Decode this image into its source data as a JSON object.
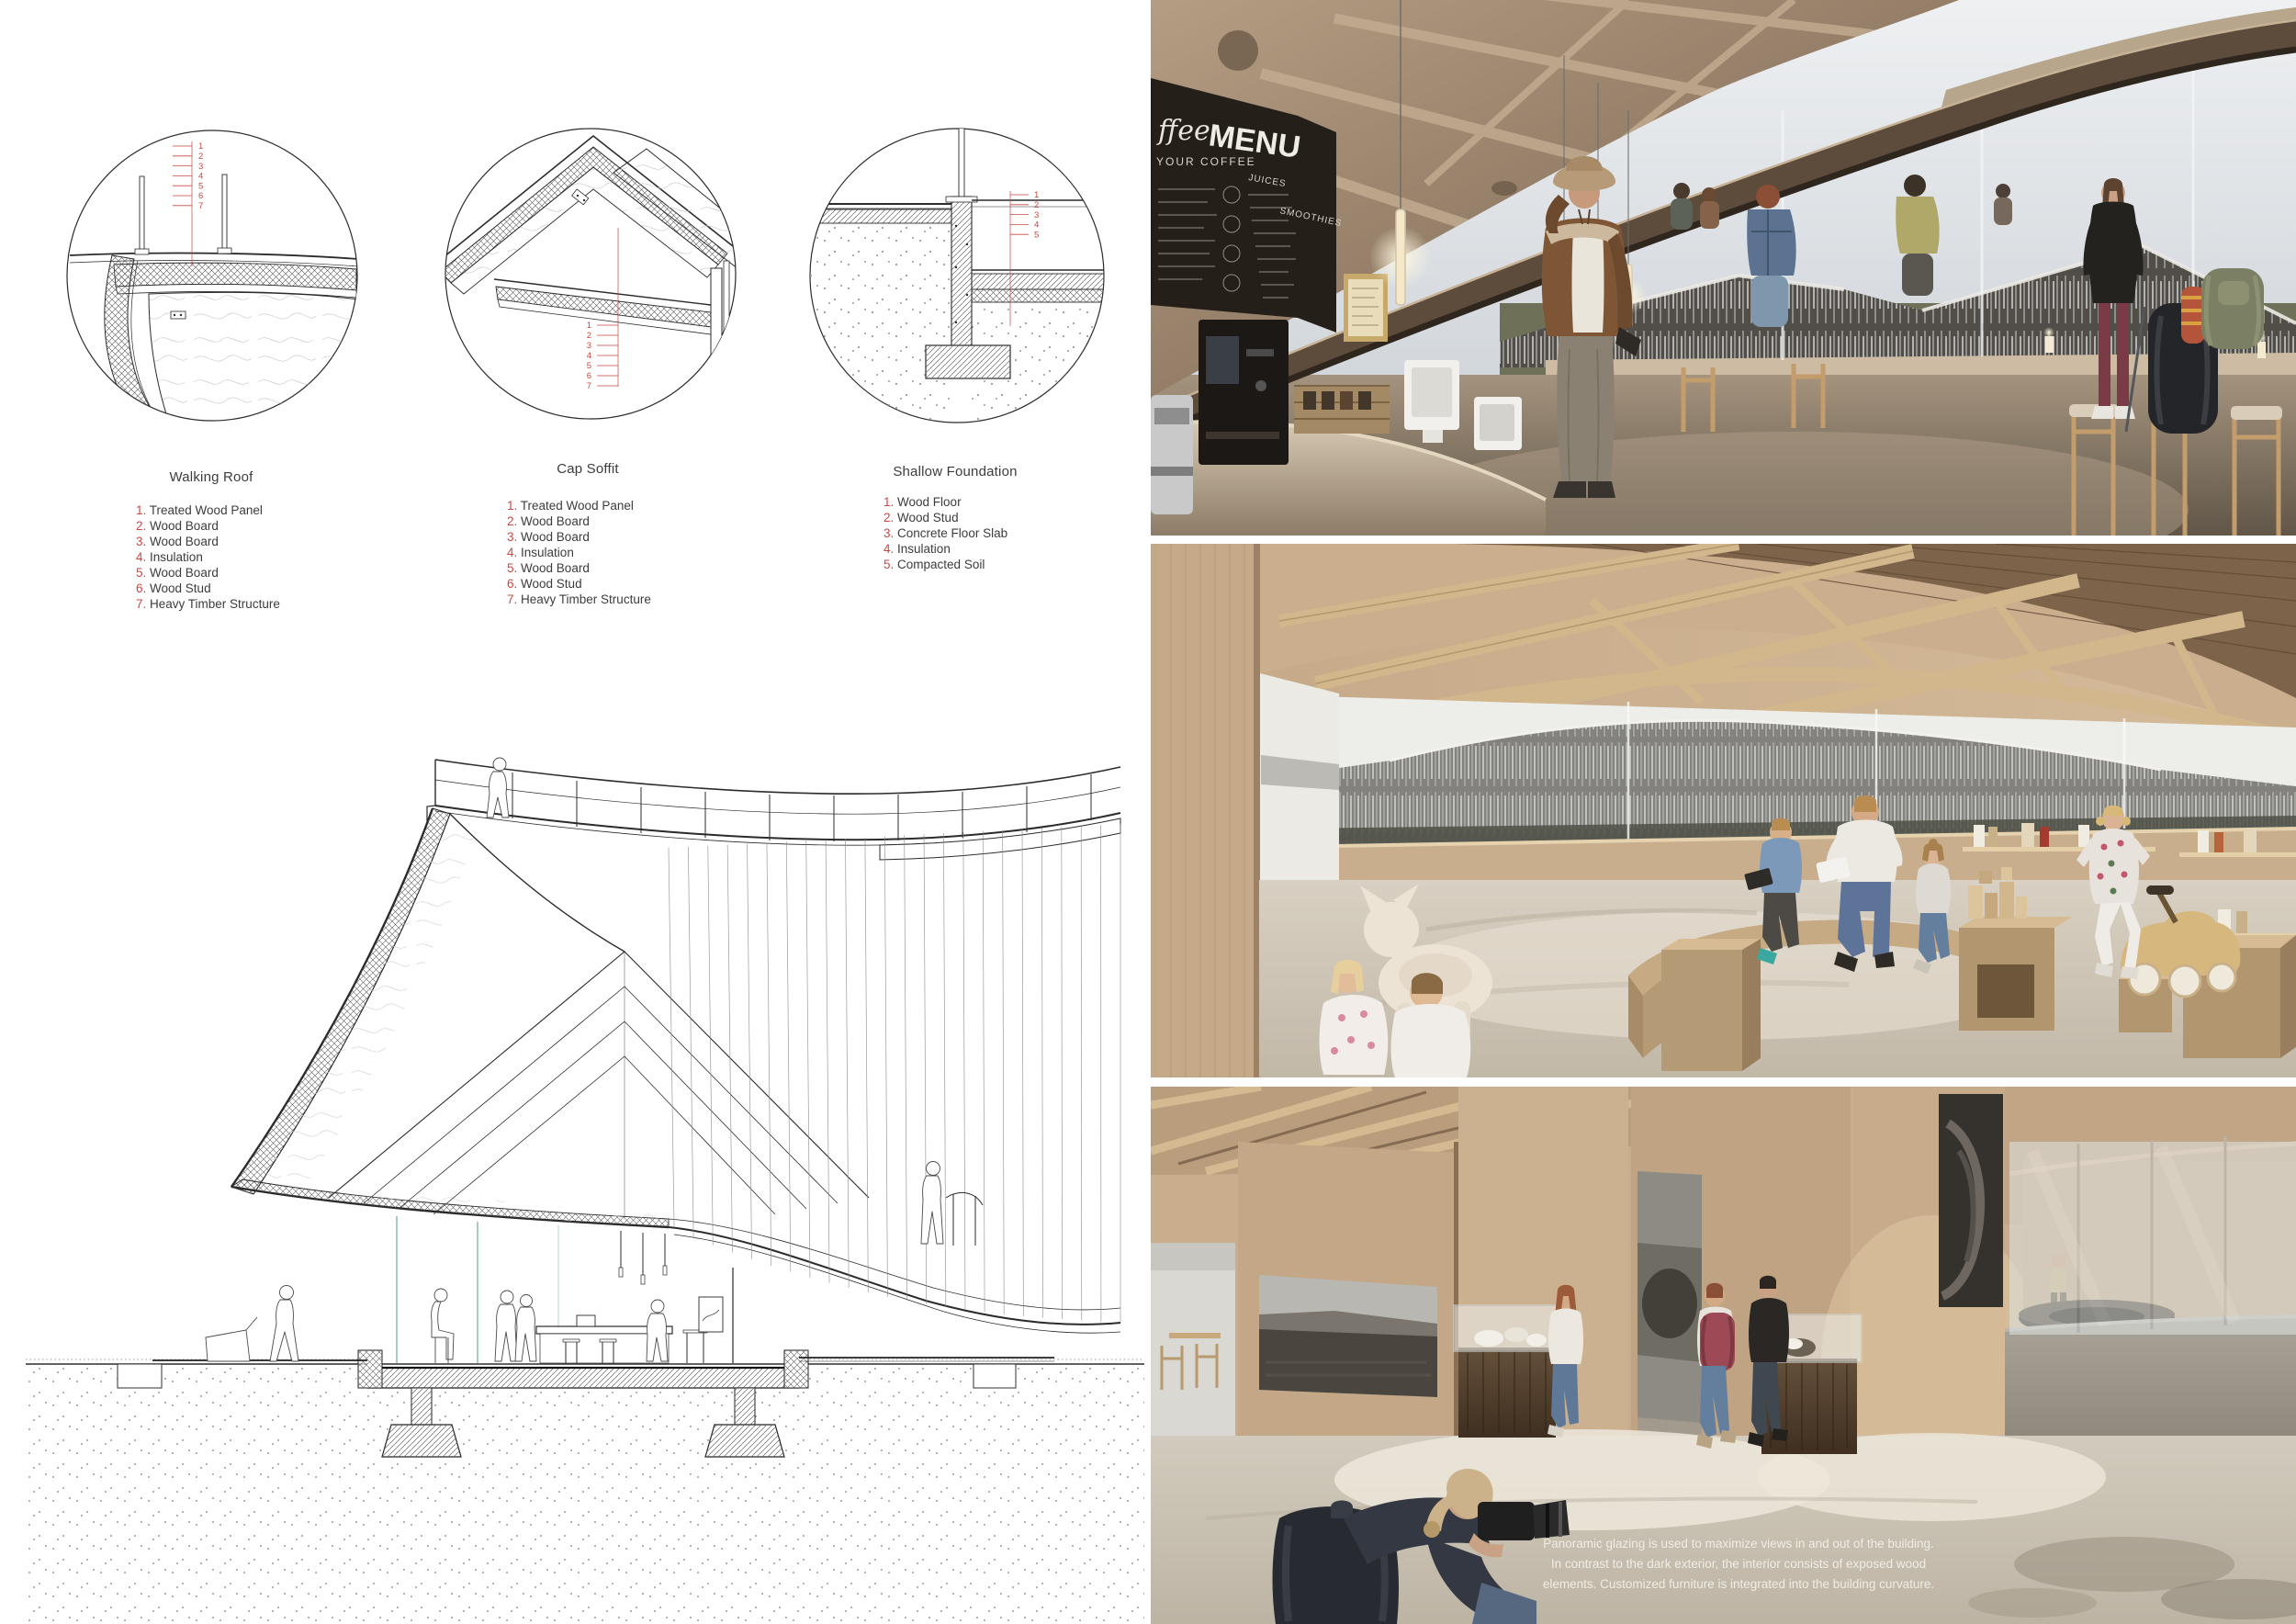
{
  "colors": {
    "accent_red": "#c94840",
    "ink": "#3e3c3b",
    "paper": "#ffffff",
    "wood_light": "#cdb292",
    "wood_dark": "#6d5a49",
    "sky": "#d4d9dd",
    "floor_concrete": "#c9c1b3",
    "chalkboard": "#231e18"
  },
  "details": {
    "panels": [
      {
        "title": "Walking Roof",
        "items": [
          "Treated Wood Panel",
          "Wood Board",
          "Wood Board",
          "Insulation",
          "Wood Board",
          "Wood Stud",
          "Heavy Timber Structure"
        ]
      },
      {
        "title": "Cap Soffit",
        "items": [
          "Treated Wood Panel",
          "Wood Board",
          "Wood Board",
          "Insulation",
          "Wood Board",
          "Wood Stud",
          "Heavy Timber Structure"
        ]
      },
      {
        "title": "Shallow Foundation",
        "items": [
          "Wood Floor",
          "Wood Stud",
          "Concrete Floor Slab",
          "Insulation",
          "Compacted Soil"
        ]
      }
    ]
  },
  "cafe_render": {
    "menu_board": {
      "script_word": "ffee",
      "title": "MENU",
      "subtitle": "YOUR COFFEE",
      "column1": "JUICES",
      "column2": "SMOOTHIES"
    }
  },
  "exhibition_render": {
    "caption_lines": [
      "Panoramic glazing is used to maximize views in and out of the building.",
      "In contrast to the dark exterior, the interior consists of exposed wood",
      "elements. Customized furniture is integrated into the building curvature."
    ]
  }
}
